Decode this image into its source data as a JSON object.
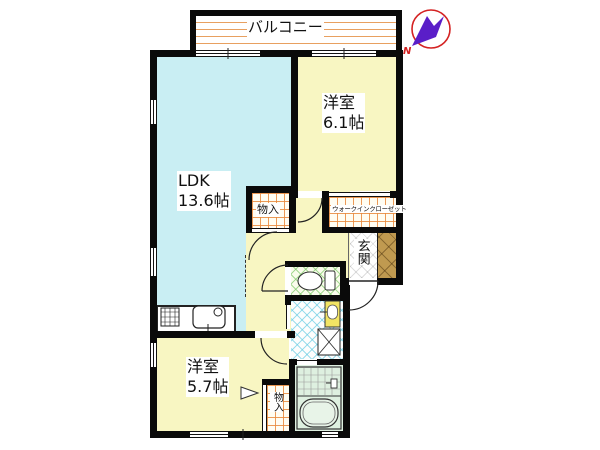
{
  "plan": {
    "balcony_label": "バルコニー",
    "compass_label": "N",
    "ldk": {
      "name": "LDK",
      "size": "13.6帖"
    },
    "bedroom_upper": {
      "name": "洋室",
      "size": "6.1帖"
    },
    "bedroom_lower": {
      "name": "洋室",
      "size": "5.7帖"
    },
    "walkin_closet_label": "ウォークインクローゼット",
    "entrance_label": "玄関",
    "storage_upper_label": "物入",
    "storage_lower_label": "物入"
  },
  "colors": {
    "wall": "#0a0a0a",
    "ldk-floor": "#c9eef3",
    "room-floor": "#f8f6c2",
    "closet-grid": "#e8893c",
    "balcony-stripe": "#e8a060",
    "toilet-hatch": "#6ec35a",
    "washroom-hatch": "#5ac8e1",
    "bath-floor": "#def0e0",
    "shoe-cabinet": "#c09a50",
    "compass-ring": "#d42222",
    "compass-needle": "#5a1ec8"
  }
}
